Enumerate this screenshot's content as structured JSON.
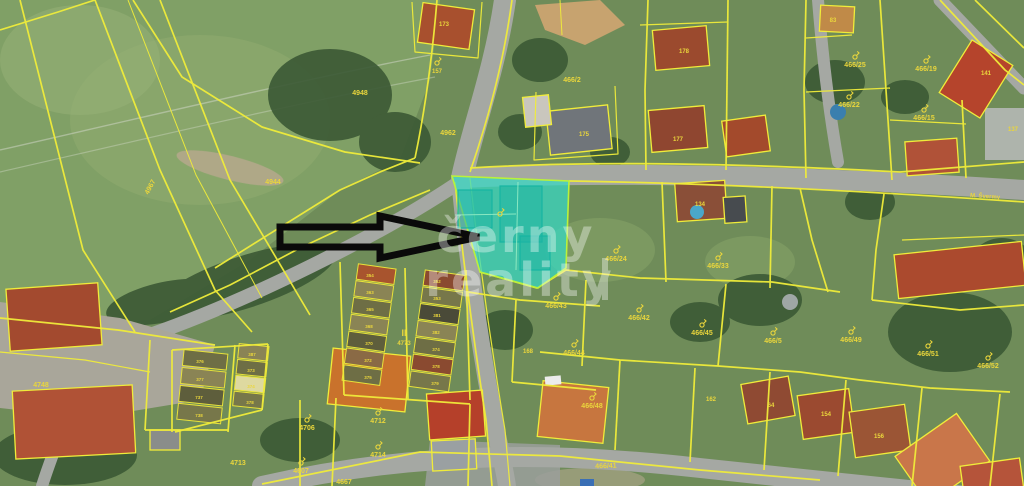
{
  "map": {
    "type": "cadastral-aerial-map",
    "label_color": "#ead63c",
    "parcel_line_color": "#f0ec3a",
    "highlight_color": "#35d9c5",
    "arrow_color": "#0a0a0a",
    "watermark": {
      "line1": "černy",
      "line2": "reality"
    },
    "labels": [
      {
        "text": "4948",
        "x": 360,
        "y": 95
      },
      {
        "text": "4944",
        "x": 273,
        "y": 184
      },
      {
        "text": "4967",
        "x": 152,
        "y": 188,
        "rot": -62
      },
      {
        "text": "4962",
        "x": 448,
        "y": 135
      },
      {
        "text": "466/2",
        "x": 572,
        "y": 82
      },
      {
        "text": "173",
        "x": 444,
        "y": 26,
        "size": 6
      },
      {
        "text": "157",
        "x": 437,
        "y": 73,
        "size": 6,
        "sym": true
      },
      {
        "text": "175",
        "x": 584,
        "y": 136,
        "size": 6
      },
      {
        "text": "178",
        "x": 684,
        "y": 53,
        "size": 6
      },
      {
        "text": "177",
        "x": 678,
        "y": 141,
        "size": 6
      },
      {
        "text": "83",
        "x": 833,
        "y": 22,
        "size": 6
      },
      {
        "text": "466/25",
        "x": 855,
        "y": 67,
        "sym": true
      },
      {
        "text": "466/19",
        "x": 926,
        "y": 71,
        "sym": true
      },
      {
        "text": "141",
        "x": 986,
        "y": 75,
        "size": 6
      },
      {
        "text": "466/22",
        "x": 849,
        "y": 107,
        "sym": true
      },
      {
        "text": "466/15",
        "x": 924,
        "y": 120,
        "sym": true
      },
      {
        "text": "137",
        "x": 1013,
        "y": 131,
        "size": 6
      },
      {
        "text": "134",
        "x": 700,
        "y": 206,
        "size": 6
      },
      {
        "text": "",
        "x": 500,
        "y": 224,
        "sym": true
      },
      {
        "text": "466/24",
        "x": 616,
        "y": 261,
        "sym": true
      },
      {
        "text": "466/33",
        "x": 718,
        "y": 268,
        "sym": true
      },
      {
        "text": "466/42",
        "x": 639,
        "y": 320,
        "sym": true
      },
      {
        "text": "466/43",
        "x": 556,
        "y": 308,
        "sym": true
      },
      {
        "text": "466/44",
        "x": 574,
        "y": 355,
        "sym": true
      },
      {
        "text": "466/45",
        "x": 702,
        "y": 335,
        "sym": true
      },
      {
        "text": "168",
        "x": 528,
        "y": 353,
        "size": 6
      },
      {
        "text": "466/48",
        "x": 592,
        "y": 408,
        "sym": true
      },
      {
        "text": "162",
        "x": 711,
        "y": 401,
        "size": 6
      },
      {
        "text": "466/41",
        "x": 606,
        "y": 468,
        "rot": -2
      },
      {
        "text": "466/5",
        "x": 773,
        "y": 343,
        "sym": true
      },
      {
        "text": "466/49",
        "x": 851,
        "y": 342,
        "sym": true
      },
      {
        "text": "466/51",
        "x": 928,
        "y": 356,
        "sym": true
      },
      {
        "text": "466/52",
        "x": 988,
        "y": 368,
        "sym": true
      },
      {
        "text": "64",
        "x": 771,
        "y": 407,
        "size": 6
      },
      {
        "text": "154",
        "x": 826,
        "y": 416,
        "size": 6
      },
      {
        "text": "156",
        "x": 879,
        "y": 438,
        "size": 6
      },
      {
        "text": "4748",
        "x": 41,
        "y": 387
      },
      {
        "text": "4713",
        "x": 238,
        "y": 465
      },
      {
        "text": "4706",
        "x": 307,
        "y": 430,
        "sym": true
      },
      {
        "text": "4712",
        "x": 378,
        "y": 423,
        "sym": true
      },
      {
        "text": "4714",
        "x": 378,
        "y": 457,
        "sym": true
      },
      {
        "text": "4607",
        "x": 301,
        "y": 473,
        "sym": true
      },
      {
        "text": "4667",
        "x": 344,
        "y": 484
      },
      {
        "text": "II",
        "x": 404,
        "y": 336,
        "size": 9
      },
      {
        "text": "4773",
        "x": 404,
        "y": 345,
        "size": 6
      },
      {
        "text": "M. Švermy",
        "x": 985,
        "y": 198,
        "rot": 4,
        "size": 6,
        "cls": "street-name-label"
      },
      {
        "text": "354",
        "x": 370,
        "y": 277,
        "size": 4.5
      },
      {
        "text": "363",
        "x": 370,
        "y": 294,
        "size": 4.5
      },
      {
        "text": "365",
        "x": 370,
        "y": 311,
        "size": 4.5
      },
      {
        "text": "368",
        "x": 369,
        "y": 328,
        "size": 4.5
      },
      {
        "text": "370",
        "x": 369,
        "y": 345,
        "size": 4.5
      },
      {
        "text": "372",
        "x": 368,
        "y": 362,
        "size": 4.5
      },
      {
        "text": "375",
        "x": 368,
        "y": 379,
        "size": 4.5
      },
      {
        "text": "352",
        "x": 437,
        "y": 283,
        "size": 4.5
      },
      {
        "text": "353",
        "x": 437,
        "y": 300,
        "size": 4.5
      },
      {
        "text": "381",
        "x": 437,
        "y": 317,
        "size": 4.5
      },
      {
        "text": "382",
        "x": 436,
        "y": 334,
        "size": 4.5
      },
      {
        "text": "374",
        "x": 436,
        "y": 351,
        "size": 4.5
      },
      {
        "text": "378",
        "x": 436,
        "y": 368,
        "size": 4.5
      },
      {
        "text": "379",
        "x": 435,
        "y": 385,
        "size": 4.5
      },
      {
        "text": "387",
        "x": 252,
        "y": 356,
        "size": 4.5
      },
      {
        "text": "373",
        "x": 251,
        "y": 372,
        "size": 4.5
      },
      {
        "text": "374",
        "x": 251,
        "y": 388,
        "size": 4.5
      },
      {
        "text": "378",
        "x": 250,
        "y": 404,
        "size": 4.5
      },
      {
        "text": "376",
        "x": 200,
        "y": 363,
        "size": 4.5
      },
      {
        "text": "377",
        "x": 200,
        "y": 381,
        "size": 4.5
      },
      {
        "text": "737",
        "x": 199,
        "y": 399,
        "size": 4.5
      },
      {
        "text": "738",
        "x": 199,
        "y": 417,
        "size": 4.5
      }
    ]
  }
}
